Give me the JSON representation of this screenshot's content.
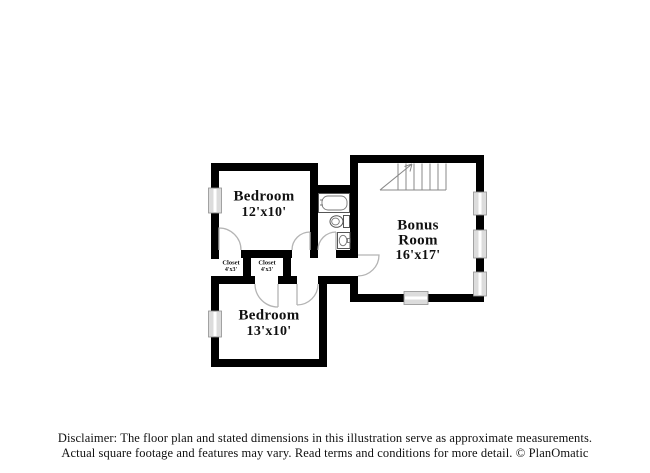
{
  "plan": {
    "bedroom_top": {
      "name": "Bedroom",
      "dims": "12'x10'"
    },
    "bonus": {
      "name_line1": "Bonus",
      "name_line2": "Room",
      "dims": "16'x17'"
    },
    "bedroom_bottom": {
      "name": "Bedroom",
      "dims": "13'x10'"
    },
    "closet_left": {
      "name": "Closet",
      "dims": "4'x3'"
    },
    "closet_right": {
      "name": "Closet",
      "dims": "4'x3'"
    }
  },
  "footer": {
    "line1": "Disclaimer: The floor plan and stated dimensions in this illustration serve as approximate measurements.",
    "line2": "Actual square footage and features may vary. Read terms and conditions for more detail. © PlanOmatic"
  },
  "colors": {
    "wall": "#000000",
    "window_fill": "#dcdcdc",
    "window_stroke": "#909090",
    "door_arc": "#b4b4b4",
    "fixture": "#555555",
    "stair": "#888888",
    "text": "#111111"
  }
}
